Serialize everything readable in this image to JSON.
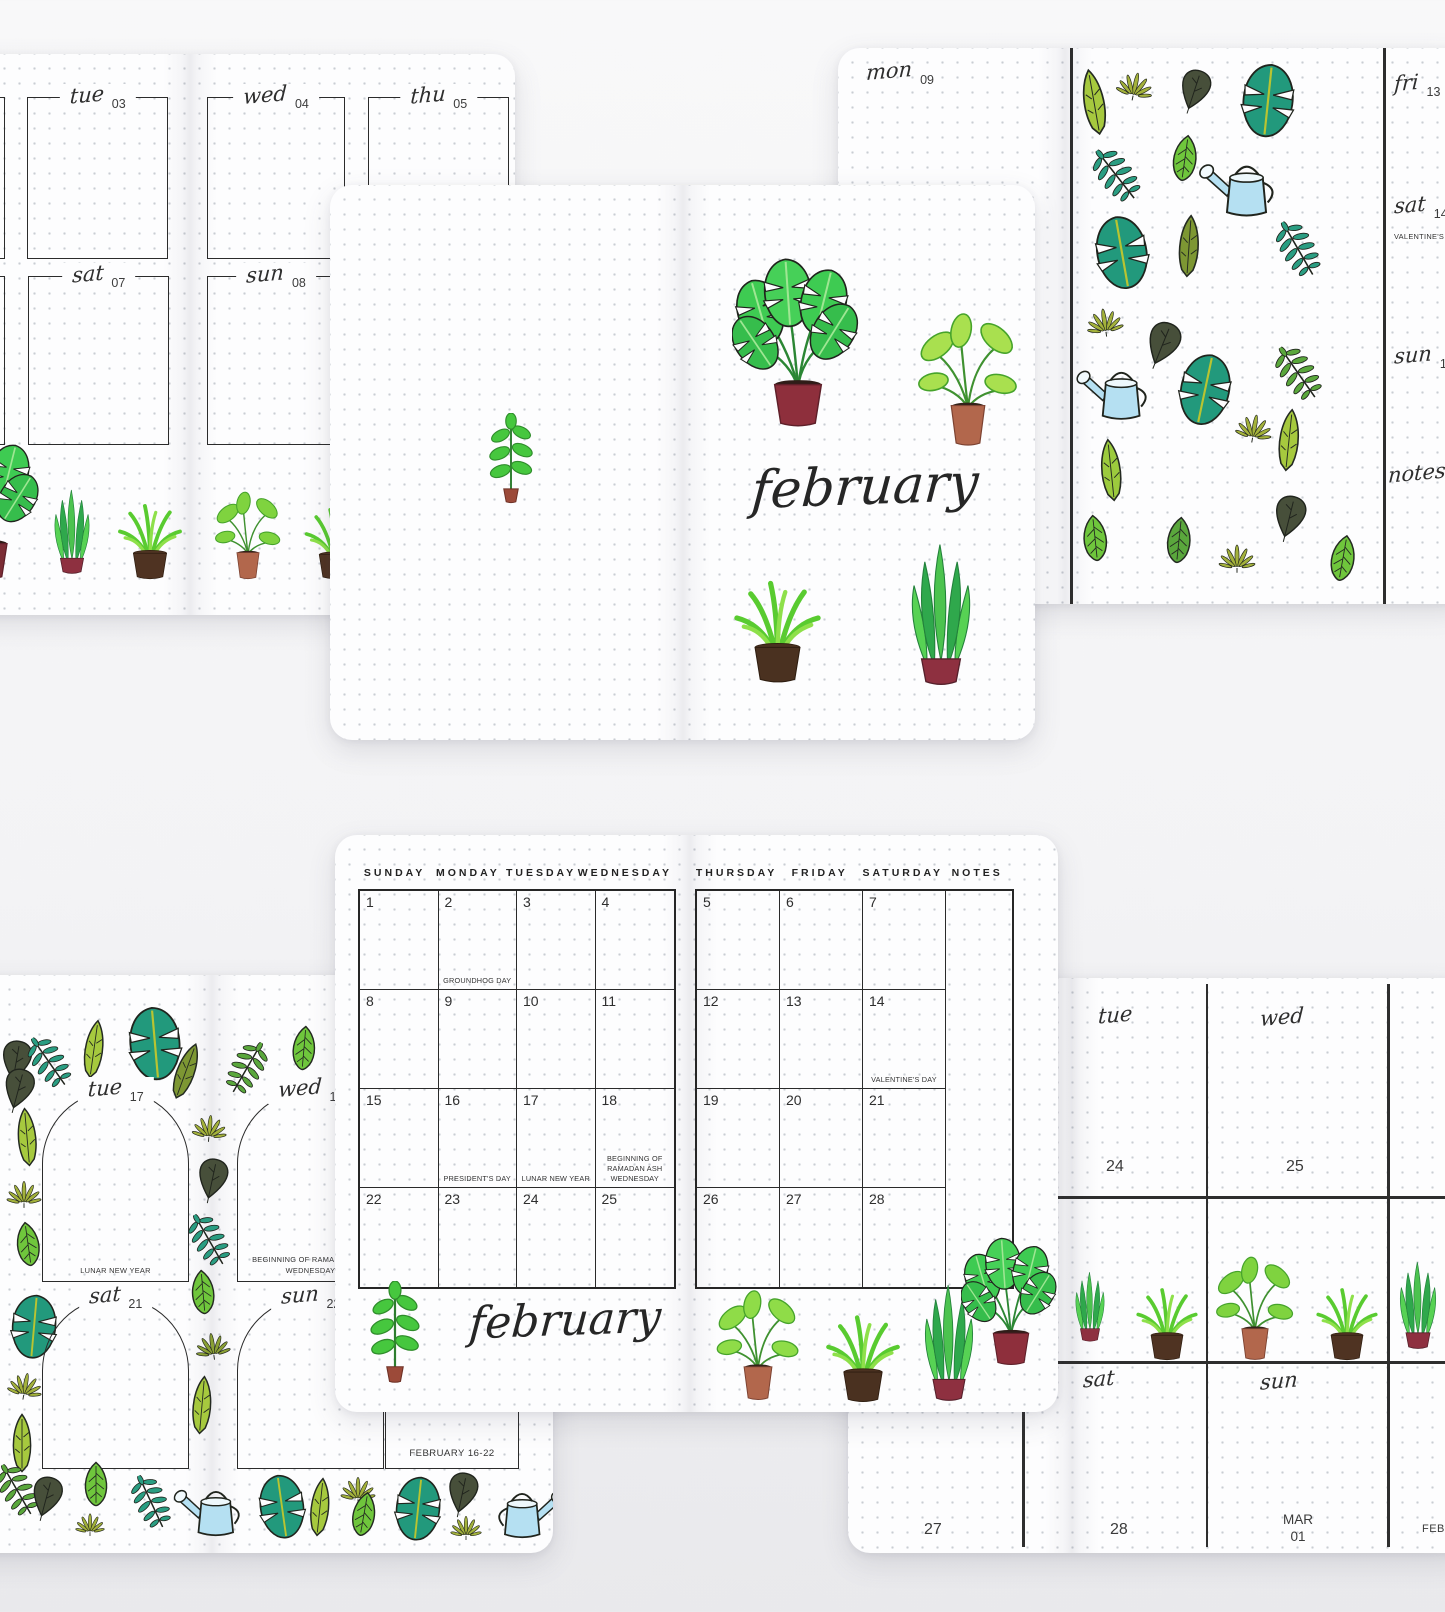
{
  "palette": {
    "ink": "#2b2b2b",
    "page": "#fdfdfe",
    "desk": "#f2f2f4",
    "leaf_green": "#3ecb52",
    "light_green": "#8fdc48",
    "teal_leaf": "#22997c",
    "olive_leaf": "#a3b13b",
    "dark_leaf": "#474f3a",
    "banana_leaf": "#a6c93e",
    "pot_dark_red": "#8e2f3c",
    "pot_terracotta": "#b2674c",
    "pot_dark_brown": "#4f3322",
    "watering_can_blue": "#b5e0f2"
  },
  "decor": {
    "icons": [
      "monstera-leaf-icon",
      "banana-leaf-icon",
      "heart-leaf-icon",
      "fern-leaf-icon",
      "hemp-leaf-icon",
      "simple-leaf-icon",
      "watering-can-icon",
      "potted-monstera-icon",
      "potted-snake-plant-icon",
      "potted-grass-plant-icon",
      "potted-leafy-plant-icon",
      "plant-sprig-icon"
    ]
  },
  "cards": {
    "top_left_weekly": {
      "days": [
        {
          "label": "tue",
          "num": "03"
        },
        {
          "label": "wed",
          "num": "04"
        },
        {
          "label": "thu",
          "num": "05"
        },
        {
          "label": "sat",
          "num": "07"
        },
        {
          "label": "sun",
          "num": "08"
        }
      ]
    },
    "cover": {
      "month_title": "february"
    },
    "top_right_weekly": {
      "monday": {
        "label": "mon",
        "num": "09"
      },
      "days": [
        {
          "label": "fri",
          "num": "13",
          "holiday": ""
        },
        {
          "label": "sat",
          "num": "14",
          "holiday": "VALENTINE'S DAY"
        },
        {
          "label": "sun",
          "num": "15",
          "holiday": ""
        }
      ],
      "notes_label": "notes"
    },
    "monthly": {
      "month_title": "february",
      "left_headers": [
        "SUNDAY",
        "MONDAY",
        "TUESDAY",
        "WEDNESDAY"
      ],
      "right_headers": [
        "THURSDAY",
        "FRIDAY",
        "SATURDAY",
        "NOTES"
      ],
      "left_cells": [
        {
          "d": "1",
          "h": ""
        },
        {
          "d": "2",
          "h": "GROUNDHOG DAY"
        },
        {
          "d": "3",
          "h": ""
        },
        {
          "d": "4",
          "h": ""
        },
        {
          "d": "8",
          "h": ""
        },
        {
          "d": "9",
          "h": ""
        },
        {
          "d": "10",
          "h": ""
        },
        {
          "d": "11",
          "h": ""
        },
        {
          "d": "15",
          "h": ""
        },
        {
          "d": "16",
          "h": "PRESIDENT'S DAY"
        },
        {
          "d": "17",
          "h": "LUNAR NEW YEAR"
        },
        {
          "d": "18",
          "h": "BEGINNING OF RAMADAN ASH WEDNESDAY"
        },
        {
          "d": "22",
          "h": ""
        },
        {
          "d": "23",
          "h": ""
        },
        {
          "d": "24",
          "h": ""
        },
        {
          "d": "25",
          "h": ""
        }
      ],
      "right_cells": [
        {
          "d": "5",
          "h": ""
        },
        {
          "d": "6",
          "h": ""
        },
        {
          "d": "7",
          "h": ""
        },
        {
          "d": "12",
          "h": ""
        },
        {
          "d": "13",
          "h": ""
        },
        {
          "d": "14",
          "h": "VALENTINE'S DAY"
        },
        {
          "d": "19",
          "h": ""
        },
        {
          "d": "20",
          "h": ""
        },
        {
          "d": "21",
          "h": ""
        },
        {
          "d": "26",
          "h": ""
        },
        {
          "d": "27",
          "h": ""
        },
        {
          "d": "28",
          "h": ""
        }
      ]
    },
    "bottom_left_weekly": {
      "arches": [
        {
          "label": "tue",
          "num": "17",
          "holiday": "LUNAR NEW YEAR"
        },
        {
          "label": "wed",
          "num": "18",
          "holiday": "BEGINNING OF RAMADAN ASH WEDNESDAY"
        },
        {
          "label": "sat",
          "num": "21",
          "holiday": ""
        },
        {
          "label": "sun",
          "num": "22",
          "holiday": ""
        }
      ],
      "week_label": "FEBRUARY 16-22"
    },
    "bottom_right_weekly": {
      "top_columns": [
        {
          "label": "tue",
          "num": "24"
        },
        {
          "label": "wed",
          "num": "25"
        }
      ],
      "bottom_columns": [
        {
          "label": "",
          "num": "27"
        },
        {
          "label": "sat",
          "num": "28"
        },
        {
          "label": "sun",
          "num": "MAR 01"
        }
      ],
      "edge_label": "FEB"
    }
  }
}
